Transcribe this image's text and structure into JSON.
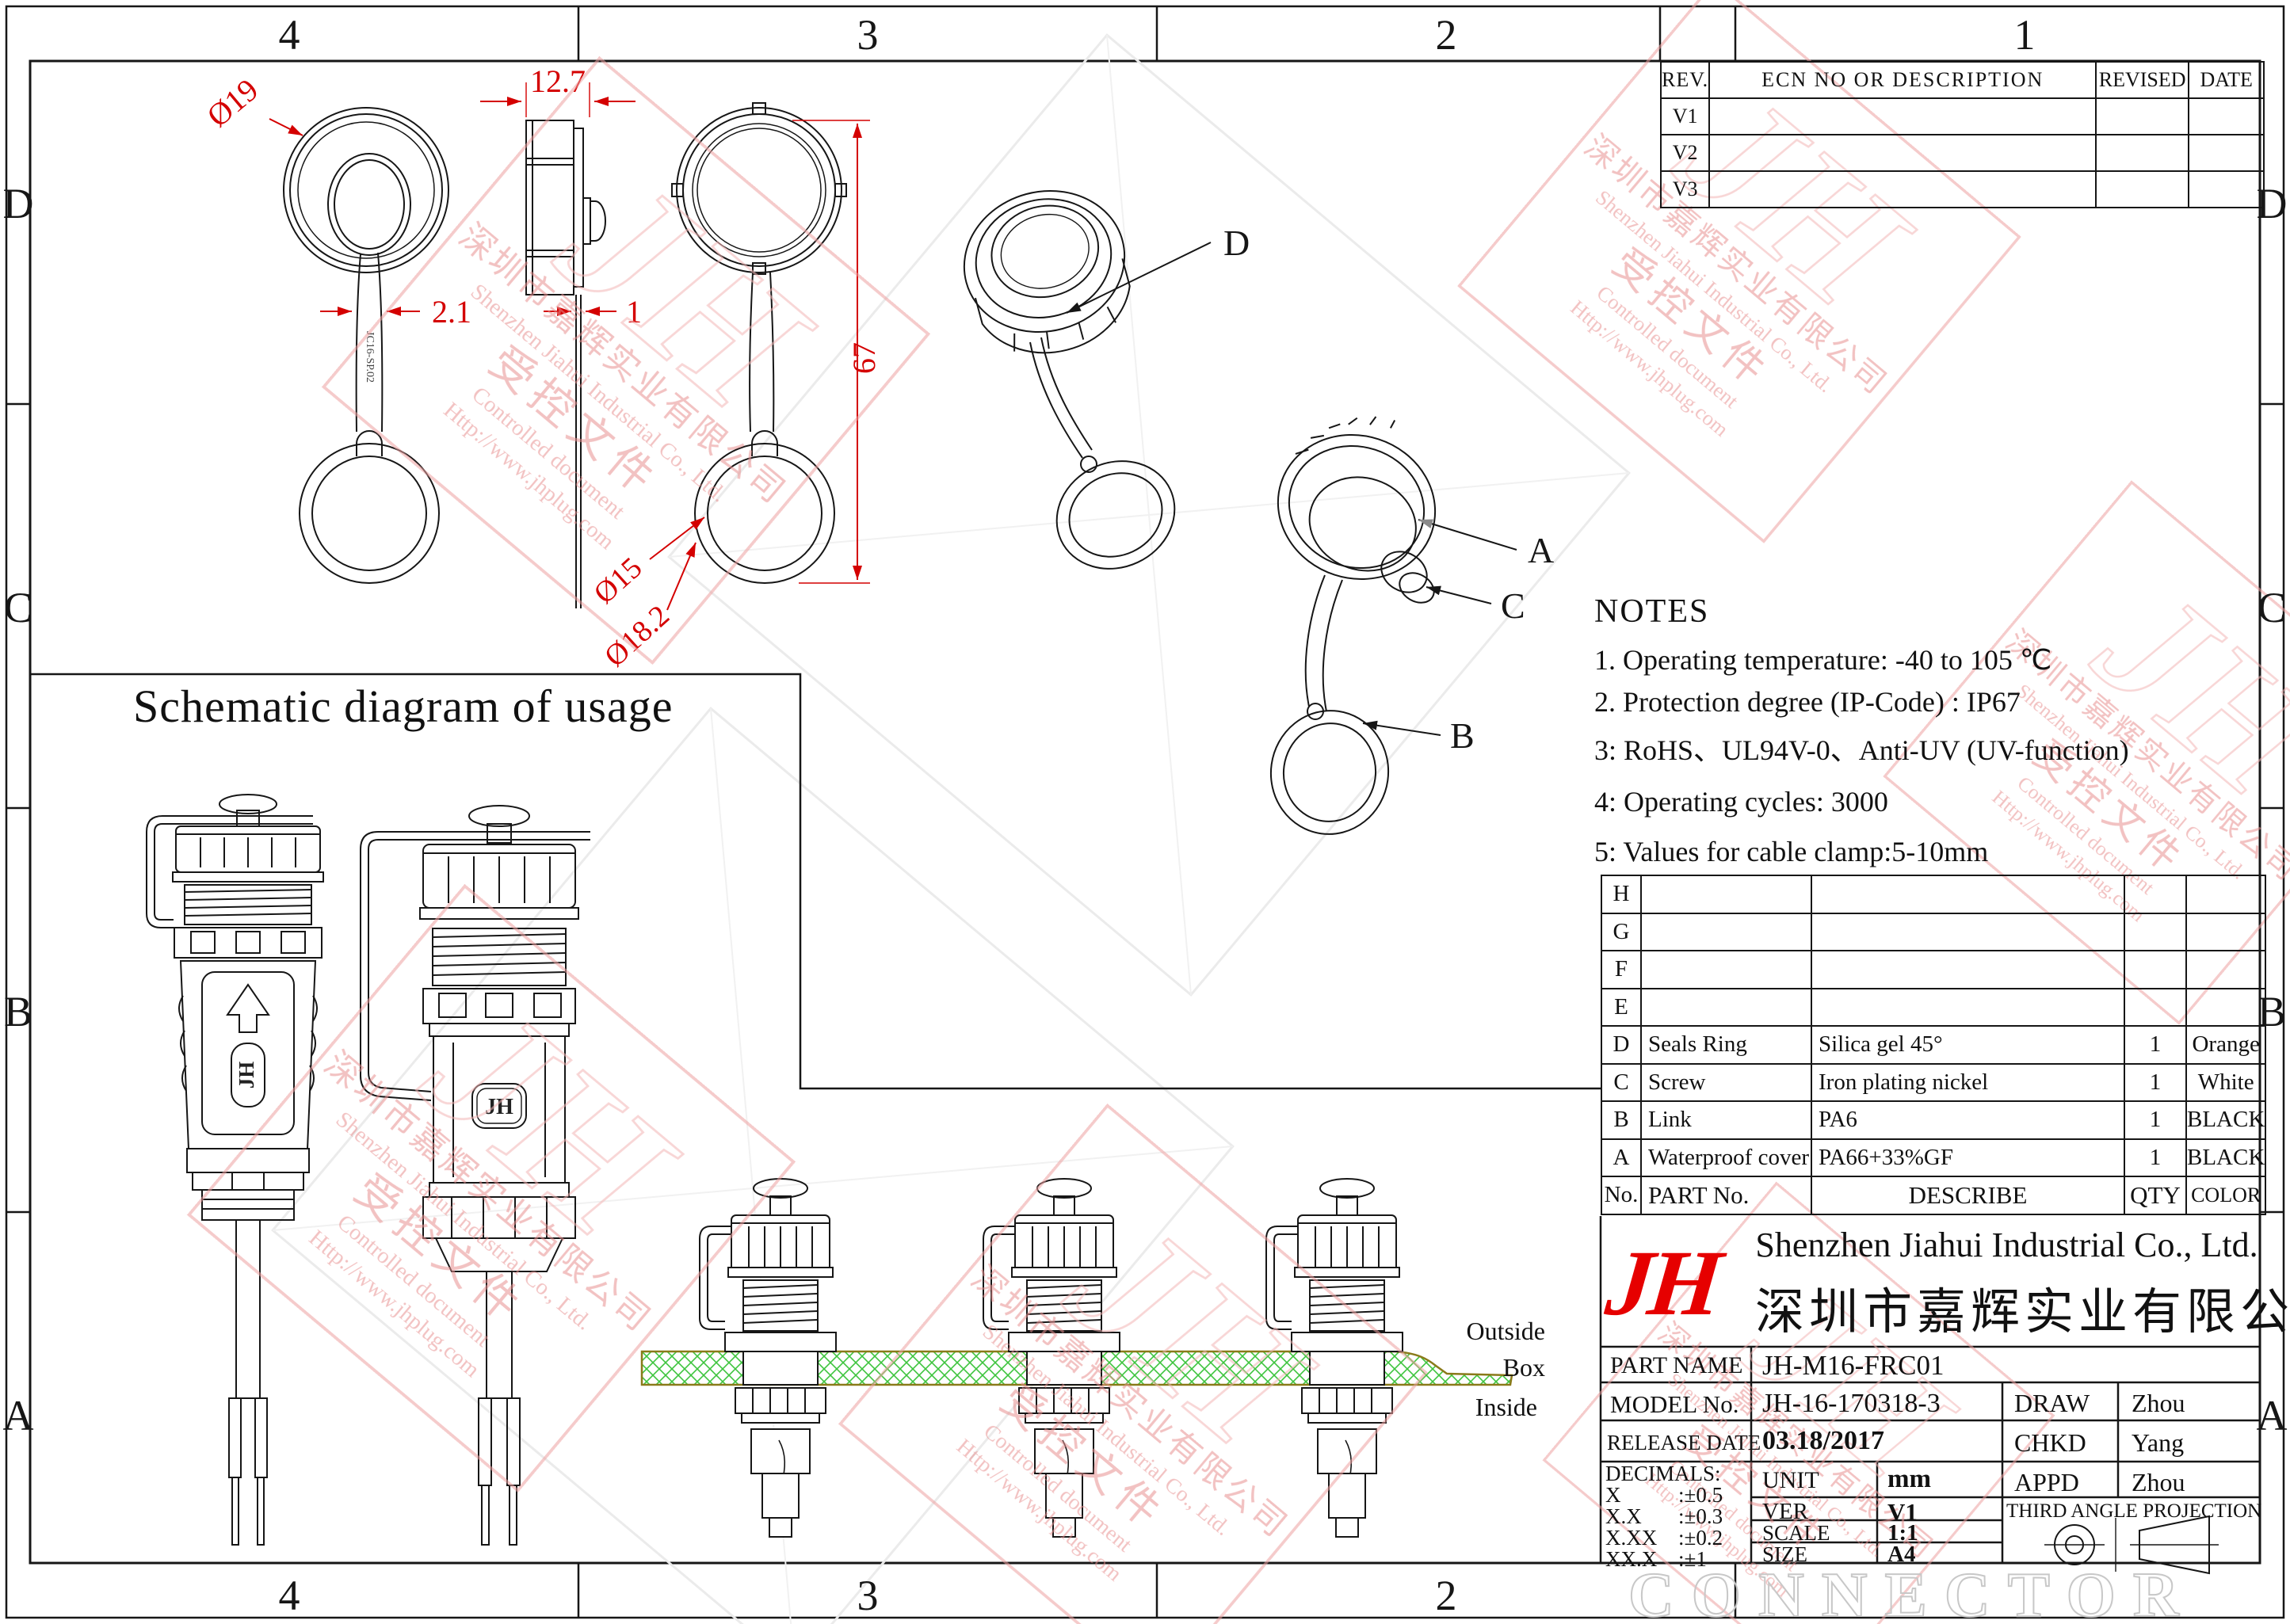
{
  "zones": {
    "columns": [
      "4",
      "3",
      "2",
      "1"
    ],
    "bottom_columns": [
      "4",
      "3",
      "2"
    ],
    "rows": [
      "D",
      "C",
      "B",
      "A"
    ]
  },
  "revision_table": {
    "headers": [
      "REV.",
      "ECN NO OR DESCRIPTION",
      "REVISED",
      "DATE"
    ],
    "rows": [
      "V1",
      "V2",
      "V3"
    ]
  },
  "drawing": {
    "dims": {
      "cap_diameter": "Ø19",
      "side_width": "12.7",
      "strap_width": "2.1",
      "plate_thickness": "1",
      "overall_height": "67",
      "ring_inner": "Ø15",
      "ring_outer": "Ø18.2"
    },
    "strap_marking": "JC16-SP.02",
    "body_logo": "JH",
    "callouts": {
      "a": "A",
      "b": "B",
      "c": "C",
      "d": "D"
    }
  },
  "notes": {
    "title": "NOTES",
    "items": [
      "1. Operating temperature: -40 to 105 ℃",
      "2. Protection degree (IP-Code) : IP67",
      "3: RoHS、UL94V-0、Anti-UV (UV-function)",
      "4: Operating cycles: 3000",
      "5: Values for cable clamp:5-10mm"
    ]
  },
  "parts_table": {
    "headers": {
      "no": "No.",
      "part": "PART No.",
      "describe": "DESCRIBE",
      "qty": "QTY",
      "color": "COLOR"
    },
    "spare_rows": [
      "H",
      "G",
      "F",
      "E"
    ],
    "rows": [
      {
        "no": "D",
        "part": "Seals Ring",
        "describe": "Silica gel 45°",
        "qty": "1",
        "color": "Orange"
      },
      {
        "no": "C",
        "part": "Screw",
        "describe": "Iron plating nickel",
        "qty": "1",
        "color": "White"
      },
      {
        "no": "B",
        "part": "Link",
        "describe": "PA6",
        "qty": "1",
        "color": "BLACK"
      },
      {
        "no": "A",
        "part": "Waterproof cover",
        "describe": "PA66+33%GF",
        "qty": "1",
        "color": "BLACK"
      }
    ]
  },
  "title_block": {
    "logo": "JH",
    "company_en": "Shenzhen Jiahui Industrial Co., Ltd.",
    "company_cn": "深圳市嘉辉实业有限公司",
    "part_name_label": "PART NAME",
    "part_name": "JH-M16-FRC01",
    "model_label": "MODEL No.",
    "model": "JH-16-170318-3",
    "release_label": "RELEASE DATE",
    "release": "03.18/2017",
    "decimals_label": "DECIMALS:",
    "decimals": [
      [
        "X",
        ":±0.5"
      ],
      [
        "X.X",
        ":±0.3"
      ],
      [
        "X.XX",
        ":±0.2"
      ],
      [
        "XX.X",
        ":±1"
      ]
    ],
    "unit_label": "UNIT",
    "unit": "mm",
    "ver_label": "VER",
    "ver": "V1",
    "scale_label": "SCALE",
    "scale": "1:1",
    "size_label": "SIZE",
    "size": "A4",
    "draw_label": "DRAW",
    "draw": "Zhou",
    "chkd_label": "CHKD",
    "chkd": "Yang",
    "appd_label": "APPD",
    "appd": "Zhou",
    "projection": "THIRD ANGLE PROJECTION"
  },
  "schematic": {
    "title": "Schematic diagram of usage",
    "outside": "Outside",
    "box": "Box",
    "inside": "Inside"
  },
  "watermark": {
    "logo": "JH",
    "company_cn": "深圳市嘉辉实业有限公司",
    "company_en": "Shenzhen Jiahui Industrial Co., Ltd.",
    "controlled_cn": "受控文件",
    "controlled_en": "Controlled document",
    "url": "Http://www.jhplug.com",
    "bottom_text": "CONNECTOR"
  },
  "colors": {
    "dimension_red": "#d40000",
    "logo_red": "#e60000",
    "watermark_pink": "#eda0a0",
    "panel_green": "#3ec43e",
    "panel_edge": "#8a7a1a",
    "line_black": "#161616",
    "faint_gray": "#c8c8c8"
  }
}
